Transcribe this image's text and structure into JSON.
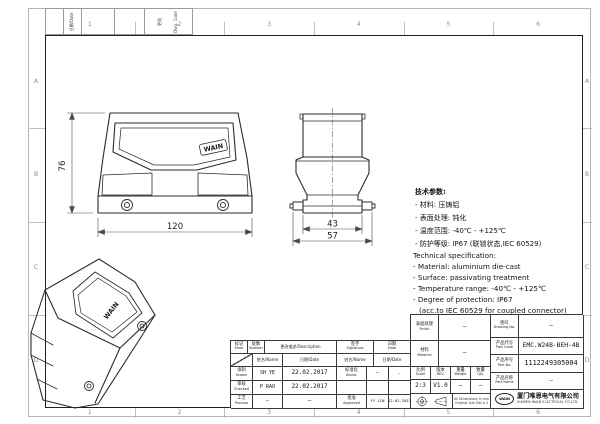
{
  "frame": {
    "grid_numbers": [
      "1",
      "2",
      "3",
      "4",
      "5",
      "6"
    ],
    "grid_letters": [
      "A",
      "B",
      "C",
      "D"
    ],
    "corner_label_1": "日期/Date",
    "corner_label_2_cn": "更改",
    "corner_label_2_en": "Dwg. Code"
  },
  "views": {
    "front": {
      "dim_height": "76",
      "dim_width": "120",
      "logo": "WAIN"
    },
    "side": {
      "dim_inner": "43",
      "dim_outer": "57"
    },
    "iso": {
      "logo": "WAIN"
    }
  },
  "spec_cn": {
    "title": "技术参数:",
    "lines": [
      "- 材料: 压铸铝",
      "- 表面处理: 钝化",
      "- 温度范围: -40℃ - +125℃",
      "- 防护等级: IP67 (联锁状态,IEC 60529)"
    ]
  },
  "spec_en": {
    "title": "Technical specification:",
    "lines": [
      "- Material: aluminium die-cast",
      "- Surface: passivating treatment",
      "- Temperature range: -40℃ - +125℃",
      "- Degree of protection: IP67",
      "  (acc.to IEC 60529 for coupled connector)"
    ]
  },
  "title_block": {
    "header": {
      "mark_cn": "标记",
      "mark_en": "Mark",
      "number_cn": "处数",
      "number_en": "Number",
      "description": "更改描述/Description",
      "sign_cn": "签字",
      "sign_en": "Signature",
      "date_cn": "日期",
      "date_en": "Date"
    },
    "subheader": {
      "name1": "姓名/Name",
      "date1": "日期/Date",
      "name2": "姓名/Name",
      "date2": "日期/Date"
    },
    "rows": [
      {
        "role_cn": "拟制",
        "role_en": "Drawn",
        "name": "SH YE",
        "date": "22.02.2017",
        "role2_cn": "标准化",
        "role2_en": "Stand.",
        "name2": "—",
        "date2": "—"
      },
      {
        "role_cn": "审核",
        "role_en": "Checked",
        "name": "P RAO",
        "date": "22.02.2017",
        "role2_cn": "",
        "role2_en": "",
        "name2": "",
        "date2": ""
      },
      {
        "role_cn": "工艺",
        "role_en": "Process",
        "name": "—",
        "date": "—",
        "role2_cn": "批准",
        "role2_en": "Approved",
        "name2": "YY LIN",
        "date2": "22.02.2017"
      }
    ],
    "finish": {
      "cn": "表面处理",
      "en": "Finish",
      "value": "—"
    },
    "material": {
      "cn": "材料",
      "en": "Material",
      "value": "—"
    },
    "scale": {
      "cn": "比例",
      "en": "Scale",
      "value": "2:3"
    },
    "rev": {
      "cn": "版本",
      "en": "REV.",
      "value": "V1.0"
    },
    "weight": {
      "cn": "重量",
      "en": "Weight",
      "value": "—"
    },
    "qty": {
      "cn": "数量",
      "en": "Qty.",
      "value": "—"
    },
    "note_line1": "All Dimensions in mm",
    "note_line2": "Original Size DIN A 4",
    "drawing_no": {
      "cn": "图号",
      "en": "Drawing No.",
      "value": "—"
    },
    "part_code": {
      "cn": "产品代号",
      "en": "Part Code",
      "value": "EMC.W24B-BEH-4B"
    },
    "part_no": {
      "cn": "产品序号",
      "en": "Part No.",
      "value": "1112249305004"
    },
    "part_name": {
      "cn": "产品名称",
      "en": "Part Name",
      "value": "—"
    },
    "company": {
      "logo": "WAIN",
      "cn": "厦门唯恩电气有限公司",
      "en": "XIAMEN WAIN ELECTRICAL CO.LTD"
    }
  }
}
